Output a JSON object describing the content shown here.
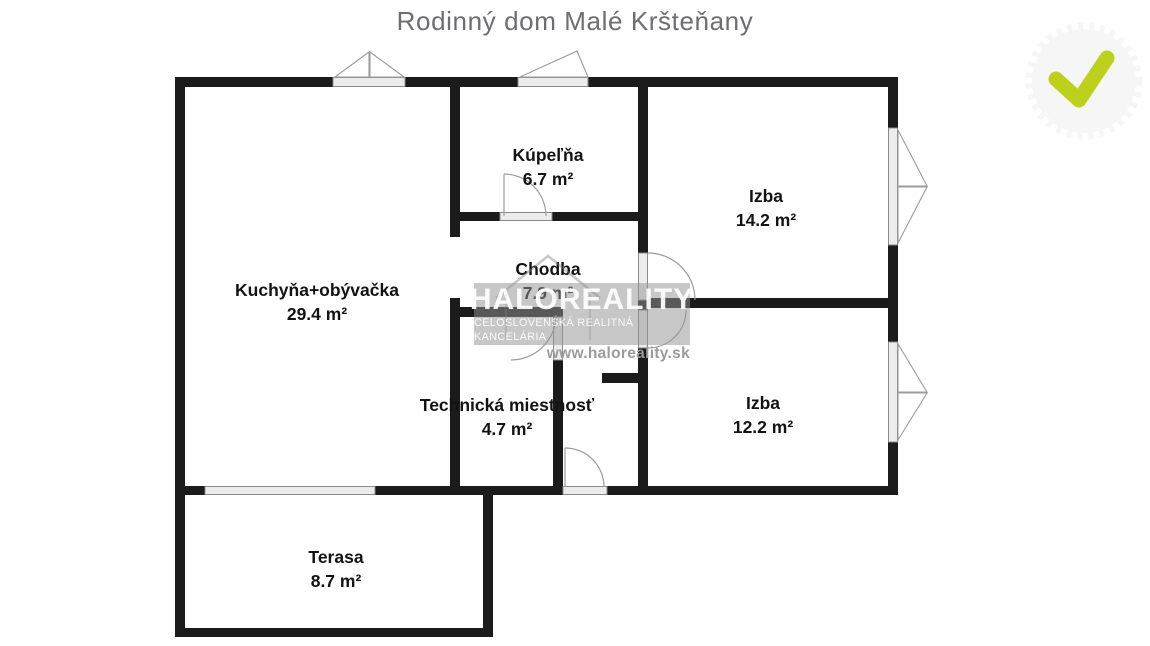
{
  "title": "Rodinný dom Malé Kršteňany",
  "rooms": [
    {
      "name": "Kuchyňa+obývačka",
      "area": "29.4 m²"
    },
    {
      "name": "Kúpeľňa",
      "area": "6.7 m²"
    },
    {
      "name": "Chodba",
      "area": "7.9 m²"
    },
    {
      "name": "Izba",
      "area": "14.2 m²"
    },
    {
      "name": "Izba",
      "area": "12.2 m²"
    },
    {
      "name": "Technická miestnosť",
      "area": "4.7 m²"
    },
    {
      "name": "Terasa",
      "area": "8.7 m²"
    }
  ],
  "watermark": {
    "brand": "HALOREALITY",
    "tagline": "CELOSLOVENSKÁ REALITNÁ KANCELÁRIA",
    "url": "www.haloreality.sk"
  },
  "badge": {
    "icon": "checkmark-icon",
    "check_color": "#bdd11c",
    "disc_color": "#f6f6f6"
  },
  "colors": {
    "wall": "#1b1b1b",
    "sill_fill": "#ececec",
    "sill_stroke": "#8a8a8a",
    "symbol_line": "#9c9c9c",
    "title_text": "#6d6d72",
    "label_text": "#131313"
  }
}
